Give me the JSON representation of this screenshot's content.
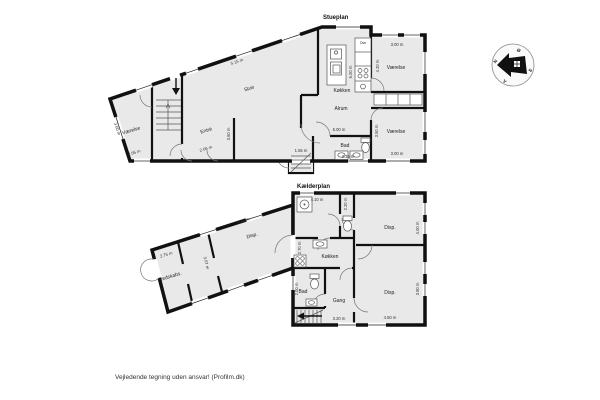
{
  "page": {
    "disclaimer": "Vejledende tegning uden ansvar! (Profilm.dk)"
  },
  "colors": {
    "wall": "#111111",
    "floor": "#e9e9e9",
    "fixture": "#ffffff",
    "dim": "#333333"
  },
  "compass": {
    "north": "N",
    "south": "S",
    "east": "Ø",
    "west": "V"
  },
  "stueplan": {
    "title": "Stueplan",
    "rooms": {
      "stue": "Stue",
      "vaerelse_wing": "Værelse",
      "entre": "Entré",
      "koekken": "Køkken",
      "ovn": "Ovn",
      "alrum": "Alrum",
      "vaerelse_ne": "Værelse",
      "vaerelse_se": "Værelse",
      "bad": "Bad"
    },
    "dims": {
      "stue_top": "5.15 m",
      "wing_left": "3.60 m",
      "vaerelse_wing_w": "2.95 m",
      "entre_w": "2.06 m",
      "entre_h": "3.60 m",
      "koekken_h": "6.00 m",
      "vaerelse_ne_w": "3.00 m",
      "vaerelse_ne_h": "4.20 m",
      "alrum_w": "5.00 m",
      "entry_w": "1.55 m",
      "bad_w": "3.35 m",
      "vaerelse_se_h": "3.50 m",
      "vaerelse_se_w": "3.00 m"
    }
  },
  "kaelderplan": {
    "title": "Kælderplan",
    "rooms": {
      "disp_wing": "Disp.",
      "redskabs": "Redskabs.",
      "koekken": "Køkken",
      "disp_ne": "Disp.",
      "bad": "Bad",
      "gang": "Gang",
      "disp_se": "Disp."
    },
    "dims": {
      "bad_top_w": "4.10 m",
      "toilet_h": "2.20 m",
      "disp_ne_h": "4.00 m",
      "koekken_h": "2.70 m",
      "bad_h": "2.00 m",
      "gang_w": "3.20 m",
      "disp_se_w": "4.50 m",
      "disp_se_h": "3.90 m",
      "wing_top": "6.35 m",
      "partition_h": "3.07 m",
      "redskabs_w": "2.75 m"
    }
  }
}
